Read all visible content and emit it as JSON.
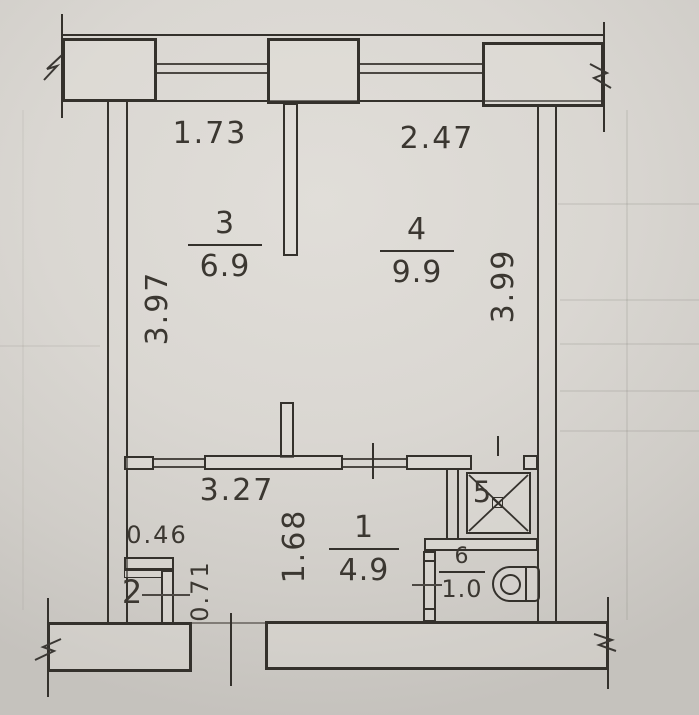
{
  "dimensions": {
    "top_left_width": "1.73",
    "top_right_width": "2.47",
    "left_height": "3.97",
    "right_height": "3.99",
    "hall_width": "3.27",
    "hall_depth": "1.68",
    "closet_width": "0.46",
    "closet_depth": "0.71"
  },
  "rooms": {
    "room1": {
      "number": "1",
      "area": "4.9"
    },
    "room2": {
      "number": "2"
    },
    "room3": {
      "number": "3",
      "area": "6.9"
    },
    "room4": {
      "number": "4",
      "area": "9.9"
    },
    "room5": {
      "number": "5"
    },
    "room6": {
      "number": "6",
      "area": "1.0"
    }
  },
  "colors": {
    "ink": "#34312c",
    "paper": "#d9d6d1"
  }
}
